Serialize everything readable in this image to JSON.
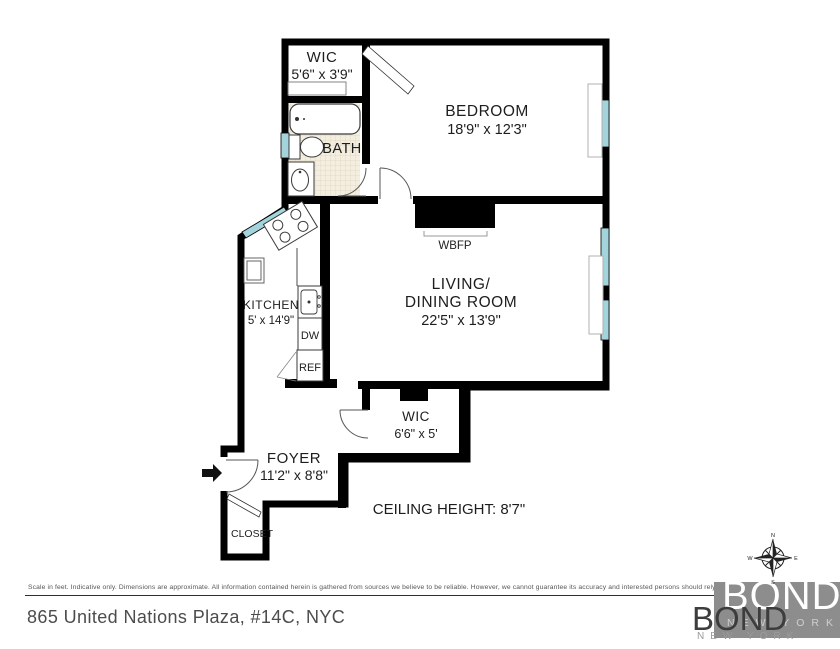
{
  "plan": {
    "wall_color": "#000000",
    "window_color": "#a3d4dc",
    "rooms": {
      "wic_top": {
        "name": "WIC",
        "dims": "5'6\" x 3'9\""
      },
      "bath": {
        "name": "BATH"
      },
      "bedroom": {
        "name": "BEDROOM",
        "dims": "18'9\" x 12'3\""
      },
      "kitchen": {
        "name": "KITCHEN",
        "dims": "5' x 14'9\""
      },
      "living_dining": {
        "name_line1": "LIVING/",
        "name_line2": "DINING ROOM",
        "dims": "22'5\" x 13'9\""
      },
      "wic_lower": {
        "name": "WIC",
        "dims": "6'6\" x 5'"
      },
      "foyer": {
        "name": "FOYER",
        "dims": "11'2\" x 8'8\""
      },
      "closet": {
        "name": "CLOSET"
      }
    },
    "labels": {
      "fireplace": "WBFP",
      "dishwasher": "DW",
      "refrigerator": "REF",
      "ceiling": "CEILING HEIGHT: 8'7\""
    },
    "compass": {
      "north": "N",
      "east": "E",
      "south": "S",
      "west": "W"
    }
  },
  "footer": {
    "disclaimer": "Scale in feet. Indicative only. Dimensions are approximate. All information contained herein is gathered from sources we believe to be reliable. However, we cannot guarantee its accuracy and interested persons should rely on their own enquiries.",
    "address": "865 United Nations Plaza, #14C, NYC",
    "logo": {
      "brand": "BOND",
      "city": "NEW YORK"
    }
  }
}
